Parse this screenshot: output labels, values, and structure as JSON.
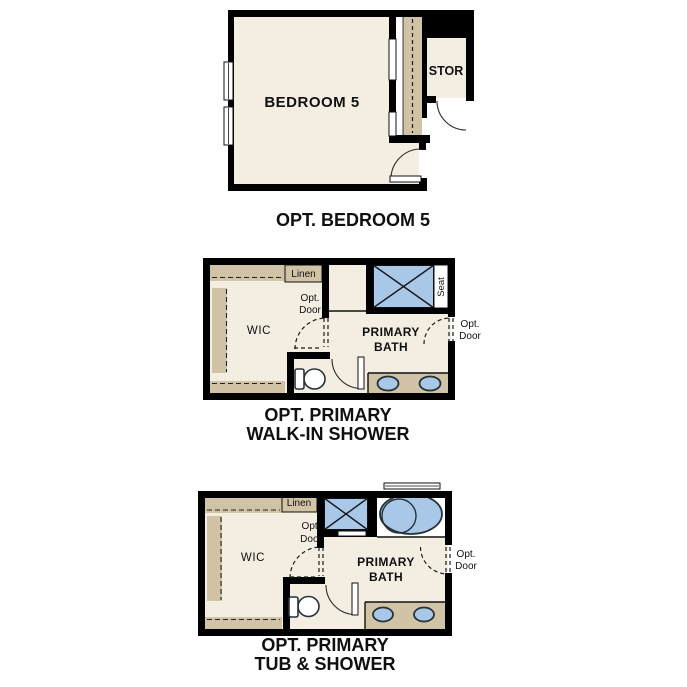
{
  "sheet": {
    "background": "#ffffff",
    "type": "floor-plan-options"
  },
  "colors": {
    "wall": "#000000",
    "floor": "#f3eee1",
    "casework": "#d1c3a5",
    "fixture_blue": "#a9c8e7",
    "fixture_outline": "#263238"
  },
  "plans": [
    {
      "id": "opt-bedroom-5",
      "title": "OPT. BEDROOM 5",
      "labels": {
        "bedroom": "BEDROOM 5",
        "storage": "STOR"
      }
    },
    {
      "id": "opt-primary-walk-in-shower",
      "title_line1": "OPT. PRIMARY",
      "title_line2": "WALK-IN SHOWER",
      "labels": {
        "linen": "Linen",
        "closet": "WIC",
        "opt_door_closet_1": "Opt.",
        "opt_door_closet_2": "Door",
        "bath_1": "PRIMARY",
        "bath_2": "BATH",
        "seat": "Seat",
        "opt_door_entry_1": "Opt.",
        "opt_door_entry_2": "Door"
      }
    },
    {
      "id": "opt-primary-tub-and-shower",
      "title_line1": "OPT. PRIMARY",
      "title_line2": "TUB & SHOWER",
      "labels": {
        "linen": "Linen",
        "closet": "WIC",
        "opt_door_closet_1": "Opt.",
        "opt_door_closet_2": "Door",
        "bath_1": "PRIMARY",
        "bath_2": "BATH",
        "opt_door_entry_1": "Opt.",
        "opt_door_entry_2": "Door"
      }
    }
  ]
}
